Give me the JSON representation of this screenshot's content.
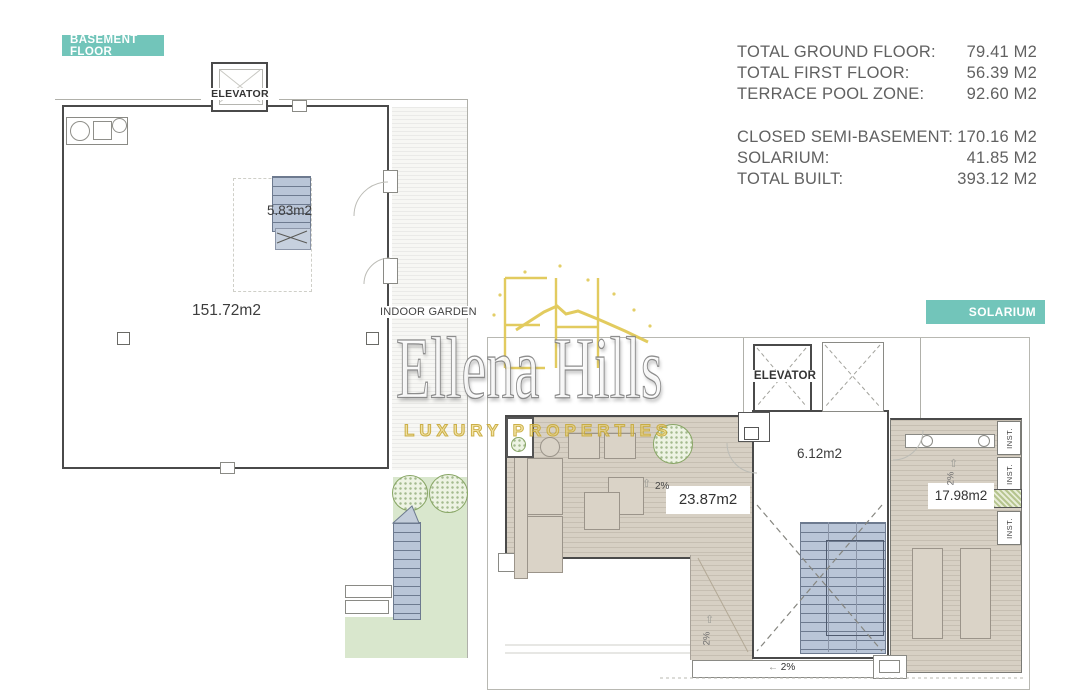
{
  "header": {
    "badge_basement": "BASEMENT FLOOR",
    "badge_solarium": "SOLARIUM"
  },
  "area_table": {
    "rows": [
      {
        "label": "TOTAL GROUND FLOOR:",
        "value": "79.41 M2"
      },
      {
        "label": "TOTAL FIRST FLOOR:",
        "value": "56.39 M2"
      },
      {
        "label": "TERRACE POOL ZONE:",
        "value": "92.60 M2"
      },
      {
        "label": "CLOSED SEMI-BASEMENT:",
        "value": "170.16 M2"
      },
      {
        "label": "SOLARIUM:",
        "value": "41.85 M2"
      },
      {
        "label": "TOTAL BUILT:",
        "value": "393.12 M2"
      }
    ]
  },
  "basement": {
    "elevator": "ELEVATOR",
    "stairs_area": "5.83m2",
    "main_area": "151.72m2",
    "indoor_garden": "INDOOR GARDEN"
  },
  "solarium": {
    "elevator": "ELEVATOR",
    "hall_area": "6.12m2",
    "west_terrace_area": "23.87m2",
    "east_terrace_area": "17.98m2",
    "inst_label": "INST.",
    "slope": "2%"
  },
  "watermark": {
    "brand": "Ellena Hills",
    "tagline": "LUXURY PROPERTIES"
  },
  "colors": {
    "badge_teal": "#72c5ba",
    "deck_tan": "#d7d0c4",
    "stairs_blue": "#b9c5d7",
    "garden_green": "#d9e7cd",
    "brand_gold": "#dfc64e",
    "table_text": "#616161",
    "wall": "#4a4a4a"
  }
}
